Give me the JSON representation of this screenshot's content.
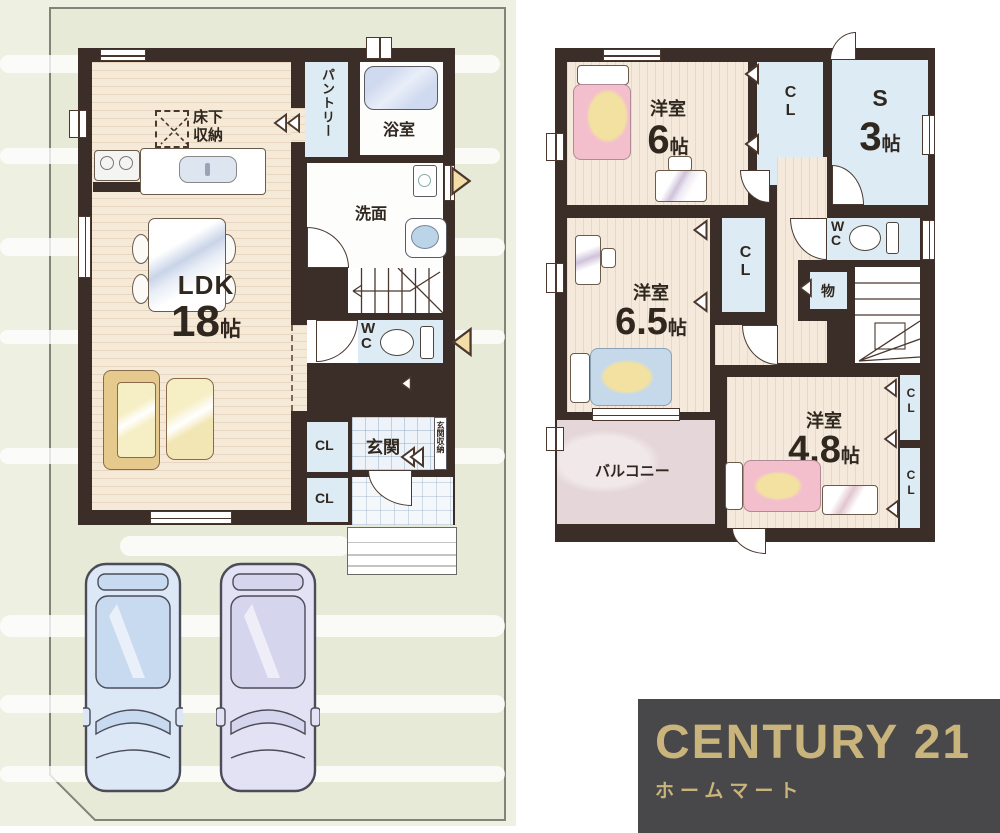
{
  "floor1": {
    "ldk": {
      "label": "LDK",
      "size": "18",
      "unit": "帖"
    },
    "underfloor_storage": "床下収納",
    "pantry": "パントリー",
    "bath": "浴室",
    "washroom": "洗面",
    "wc": "WC",
    "cl_upper": "CL",
    "cl_lower": "CL",
    "genkan": "玄関",
    "genkan_storage": "玄関収納"
  },
  "floor2": {
    "bedroom6": {
      "label": "洋室",
      "size": "6",
      "unit": "帖"
    },
    "closet_top": "CL",
    "service_room": {
      "label": "S",
      "size": "3",
      "unit": "帖"
    },
    "wc": "WC",
    "storage": "物",
    "bedroom65": {
      "label": "洋室",
      "size": "6.5",
      "unit": "帖"
    },
    "closet_mid": "CL",
    "balcony": "バルコニー",
    "bedroom48": {
      "label": "洋室",
      "size": "4.8",
      "unit": "帖"
    },
    "closet_right_upper": "CL",
    "closet_right_lower": "CL"
  },
  "brand": {
    "name": "CENTURY 21",
    "subtitle": "ホームマート"
  },
  "colors": {
    "brand_gold": "#c9b47c",
    "brand_bg": "#48474a",
    "site_green": "#e7ead6",
    "wall": "#3b2d27",
    "wood_floor": "#f5e9d8",
    "closet_blue": "#dcebf4",
    "balcony_pink": "#e5d6d9"
  }
}
